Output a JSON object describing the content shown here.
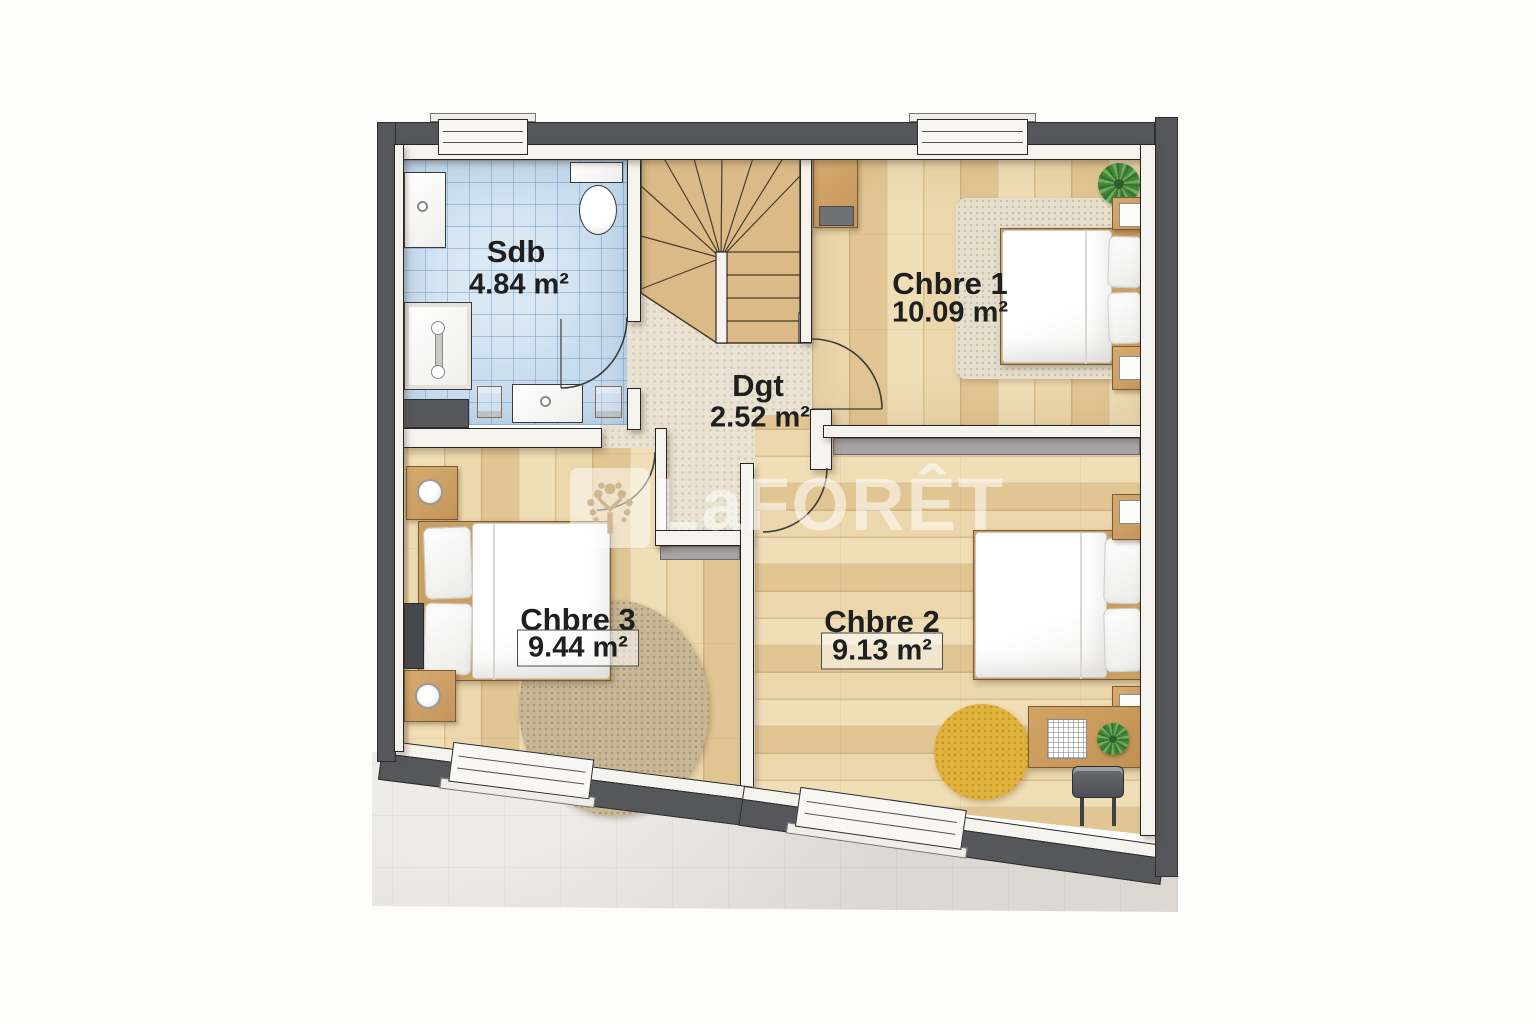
{
  "floorplan": {
    "watermark": {
      "logo_text": "LaFORÊT",
      "tree_icon": "tree-icon"
    },
    "rooms": [
      {
        "id": "sdb",
        "name": "Sdb",
        "area": "4.84 m²"
      },
      {
        "id": "chbre1",
        "name": "Chbre 1",
        "area": "10.09 m²"
      },
      {
        "id": "dgt",
        "name": "Dgt",
        "area": "2.52 m²"
      },
      {
        "id": "chbre3",
        "name": "Chbre 3",
        "area": "9.44 m²"
      },
      {
        "id": "chbre2",
        "name": "Chbre 2",
        "area": "9.13 m²"
      }
    ],
    "colors": {
      "exterior_wall": "#56575b",
      "interior_wall": "#f5f3ed",
      "bathroom_tile": "#c6dbed",
      "wood_floor": "#e9d3a7",
      "hall_carpet": "#e9e2d2",
      "stairs_wood": "#dcba88",
      "rug_yellow": "#dfb33c",
      "rug_round_brown": "#c9b795",
      "rug_beige": "#e6dfcd",
      "plant_green": "#47853e",
      "ground_gray": "#dcd8d2"
    }
  }
}
